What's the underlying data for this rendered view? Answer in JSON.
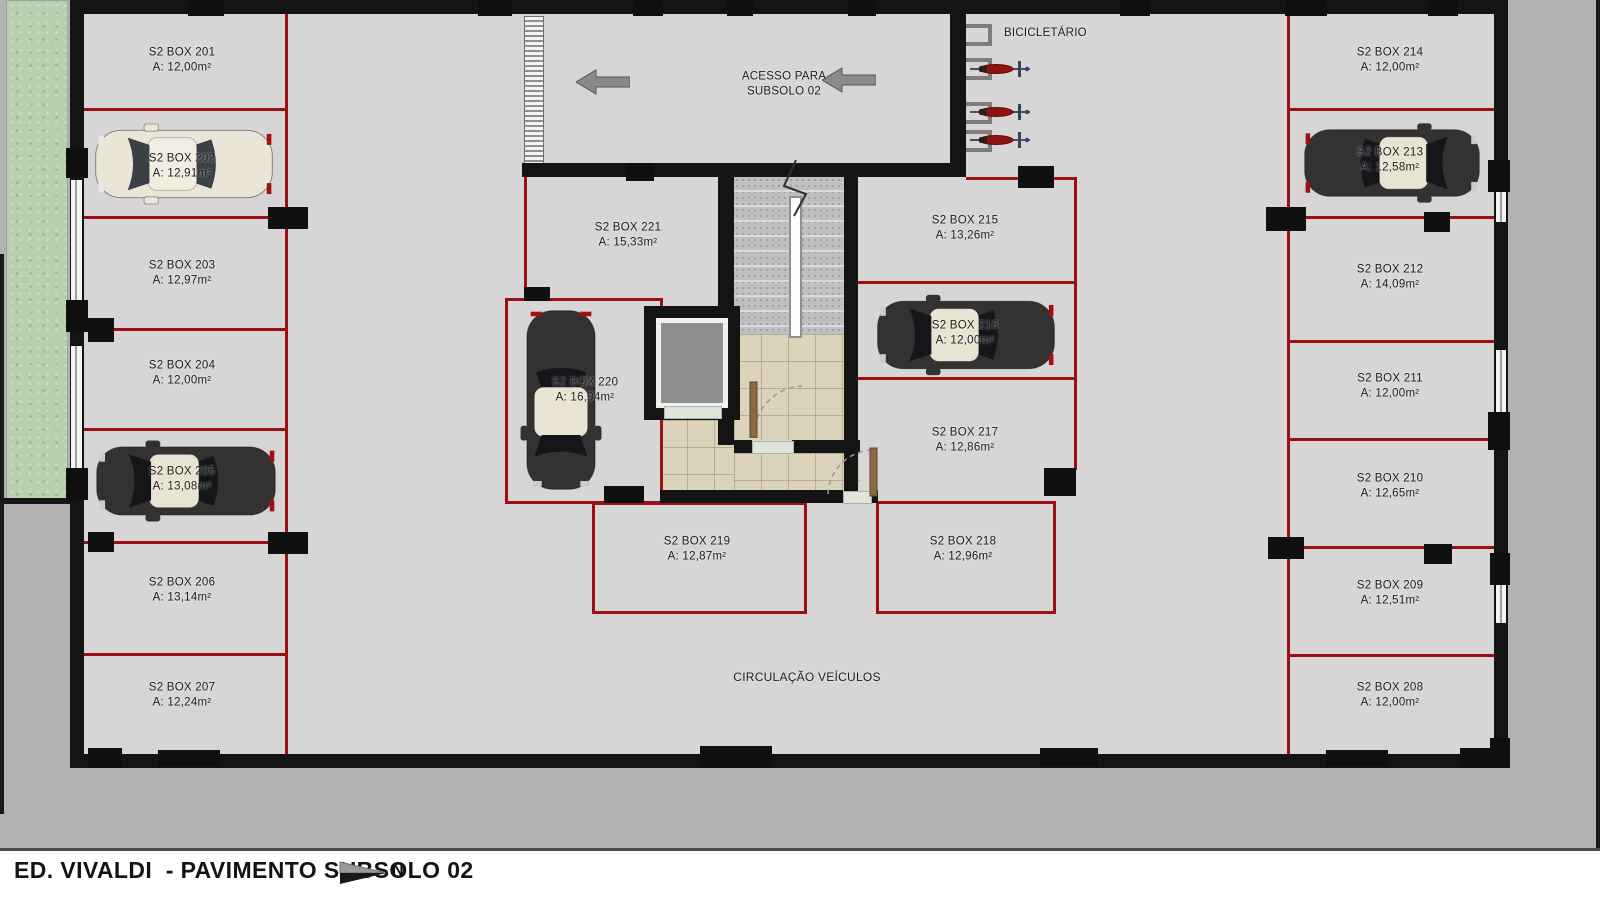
{
  "title_bar": {
    "title": "ED. VIVALDI  - PAVIMENTO SUBSOLO 02",
    "north_label": "N"
  },
  "labels": {
    "ramp_line1": "ACESSO PARA",
    "ramp_line2": "SUBSOLO 02",
    "bike_area": "BICICLETÁRIO",
    "circulation": "CIRCULAÇÃO VEÍCULOS"
  },
  "boxes": [
    {
      "name": "S2 BOX 201",
      "area": "A: 12,00m²"
    },
    {
      "name": "S2 BOX 202",
      "area": "A: 12,91m²"
    },
    {
      "name": "S2 BOX 203",
      "area": "A: 12,97m²"
    },
    {
      "name": "S2 BOX 204",
      "area": "A: 12,00m²"
    },
    {
      "name": "S2 BOX 205",
      "area": "A: 13,08m²"
    },
    {
      "name": "S2 BOX 206",
      "area": "A: 13,14m²"
    },
    {
      "name": "S2 BOX 207",
      "area": "A: 12,24m²"
    },
    {
      "name": "S2 BOX 208",
      "area": "A: 12,00m²"
    },
    {
      "name": "S2 BOX 209",
      "area": "A: 12,51m²"
    },
    {
      "name": "S2 BOX 210",
      "area": "A: 12,65m²"
    },
    {
      "name": "S2 BOX 211",
      "area": "A: 12,00m²"
    },
    {
      "name": "S2 BOX 212",
      "area": "A: 14,09m²"
    },
    {
      "name": "S2 BOX 213",
      "area": "A: 12,58m²"
    },
    {
      "name": "S2 BOX 214",
      "area": "A: 12,00m²"
    },
    {
      "name": "S2 BOX 215",
      "area": "A: 13,26m²"
    },
    {
      "name": "S2 BOX 216",
      "area": "A: 12,00m²"
    },
    {
      "name": "S2 BOX 217",
      "area": "A: 12,86m²"
    },
    {
      "name": "S2 BOX 218",
      "area": "A: 12,96m²"
    },
    {
      "name": "S2 BOX 219",
      "area": "A: 12,87m²"
    },
    {
      "name": "S2 BOX 220",
      "area": "A: 16,94m²"
    },
    {
      "name": "S2 BOX 221",
      "area": "A: 15,33m²"
    }
  ],
  "colors": {
    "divider_red": "#9b1113",
    "wall_black": "#141414",
    "floor_gray": "#d7d5d5",
    "exterior_gray": "#b2b2b2",
    "tile_beige": "#dcd3bc",
    "stair_gray": "#bfbfc2",
    "grass_green": "#b6cfae"
  }
}
